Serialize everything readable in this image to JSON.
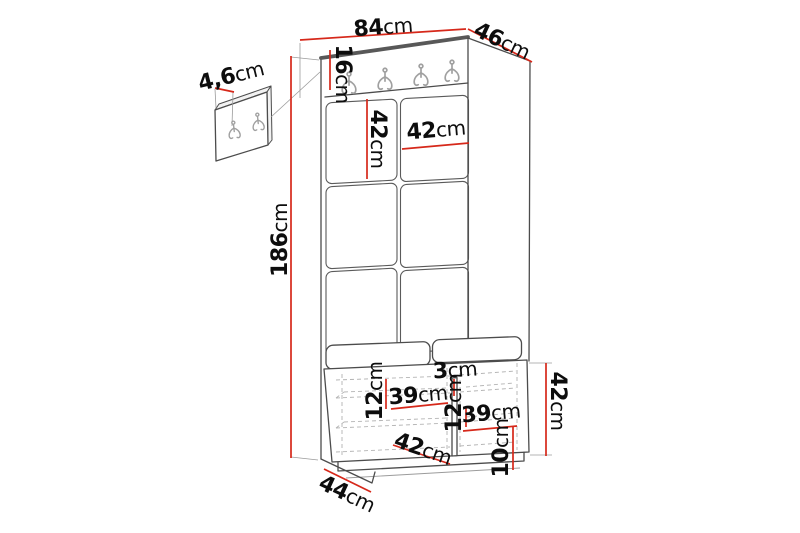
{
  "colors": {
    "dimension_red": "#d6281a",
    "line_dark": "#4c4c4c",
    "line_light": "#9b9b9b",
    "dash_gray": "#b3b3b3",
    "background": "#ffffff",
    "text": "#0d0d0d"
  },
  "icons": {
    "coat_hook": "double-prong-wall-hook"
  },
  "labels": {
    "total_width": {
      "v": "84",
      "u": "cm"
    },
    "total_depth": {
      "v": "46",
      "u": "cm"
    },
    "rail_height": {
      "v": "16",
      "u": "cm"
    },
    "panel_thickness": {
      "v": "4,6",
      "u": "cm"
    },
    "tile_height": {
      "v": "42",
      "u": "cm"
    },
    "tile_width": {
      "v": "42",
      "u": "cm"
    },
    "total_height": {
      "v": "186",
      "u": "cm"
    },
    "divider_thickness": {
      "v": "3",
      "u": "cm"
    },
    "left_shelf_gap": {
      "v": "12",
      "u": "cm"
    },
    "left_compartment_width": {
      "v": "39",
      "u": "cm"
    },
    "right_shelf_gap": {
      "v": "12",
      "u": "cm"
    },
    "right_compartment_width": {
      "v": "39",
      "u": "cm"
    },
    "bench_inner_depth": {
      "v": "42",
      "u": "cm"
    },
    "plinth_height": {
      "v": "10",
      "u": "cm"
    },
    "bench_height": {
      "v": "42",
      "u": "cm"
    },
    "bench_depth": {
      "v": "44",
      "u": "cm"
    }
  }
}
